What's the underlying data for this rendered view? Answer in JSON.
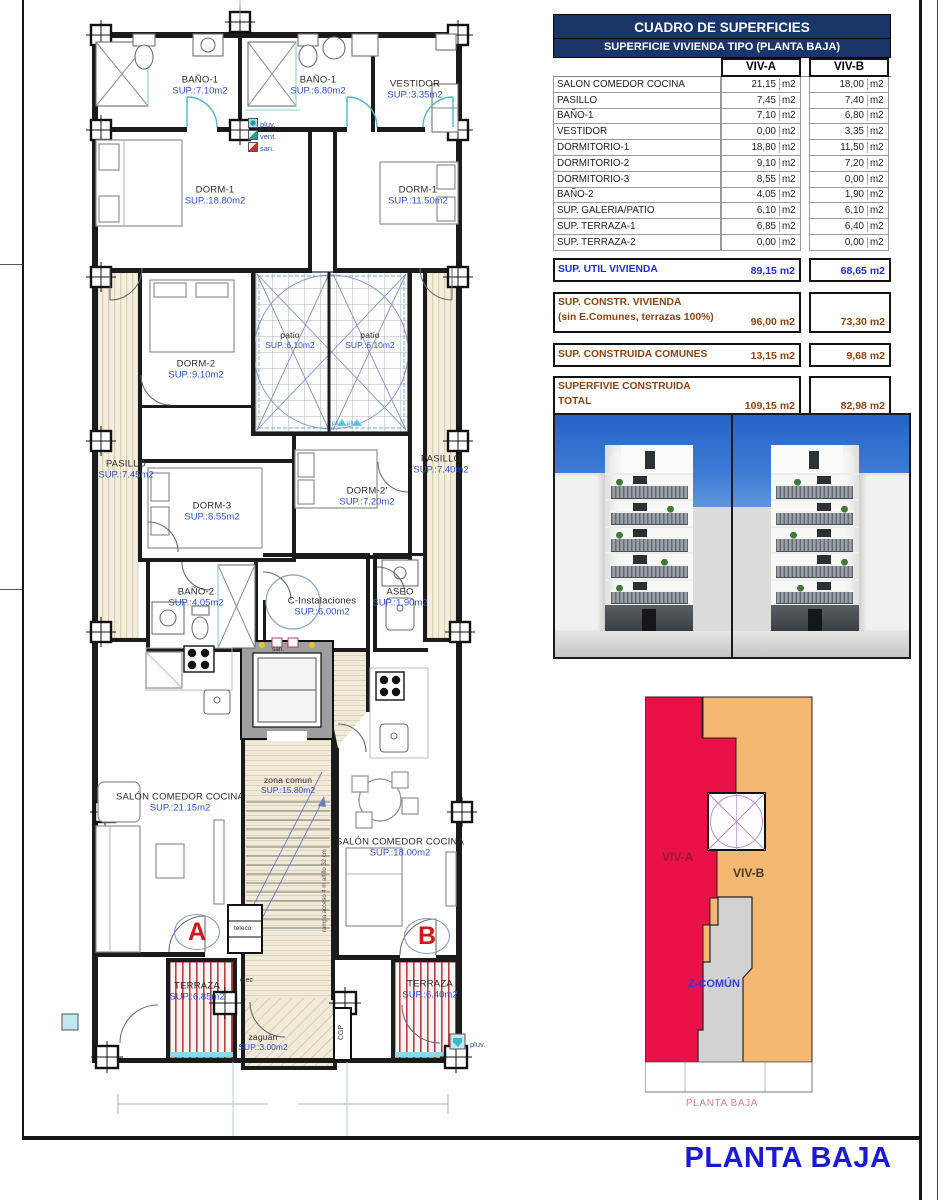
{
  "plan": {
    "rooms": {
      "bano1a": {
        "name": "BAÑO-1",
        "area": "SUP.:7.10m2"
      },
      "bano1b": {
        "name": "BAÑO-1",
        "area": "SUP.:6.80m2"
      },
      "vestidor": {
        "name": "VESTIDOR",
        "area": "SUP.:3.35m2"
      },
      "dorm1a": {
        "name": "DORM-1",
        "area": "SUP.:18.80m2"
      },
      "dorm1b": {
        "name": "DORM-1",
        "area": "SUP.:11.50m2"
      },
      "dorm2": {
        "name": "DORM-2",
        "area": "SUP.:9.10m2"
      },
      "patio1": {
        "name": "patio",
        "area": "SUP.:6.10m2"
      },
      "patio2": {
        "name": "patio",
        "area": "SUP.:6.10m2"
      },
      "pasillo_a": {
        "name": "PASILLO",
        "area": "SUP.:7.45m2"
      },
      "pasillo_b": {
        "name": "PASILLO",
        "area": "SUP.:7.40m2"
      },
      "dorm3": {
        "name": "DORM-3",
        "area": "SUP.:8.55m2"
      },
      "dorm2b": {
        "name": "DORM-2'",
        "area": "SUP.:7.20m2"
      },
      "bano2": {
        "name": "BAÑO-2",
        "area": "SUP.:4.05m2"
      },
      "cinst": {
        "name": "C-Instalaciones",
        "area": "SUP.:6.00m2"
      },
      "aseo": {
        "name": "ASEO",
        "area": "SUP.:1.90m2"
      },
      "salon_a": {
        "name": "SALÓN COMEDOR COCINA",
        "area": "SUP.:21.15m2"
      },
      "zona": {
        "name": "zona comun",
        "area": "SUP.:15.80m2"
      },
      "salon_b": {
        "name": "SALÓN COMEDOR COCINA",
        "area": "SUP.:18.00m2"
      },
      "terraza_a": {
        "name": "TERRAZA",
        "area": "SUP.:6.85m2"
      },
      "terraza_b": {
        "name": "TERRAZA",
        "area": "SUP.:6.40m2"
      },
      "zaguan": {
        "name": "zaguán",
        "area": "SUP.:3.00m2"
      }
    },
    "markers": {
      "letter_a": "A",
      "letter_b": "B",
      "teleco": "teleco",
      "elec": "elec",
      "san": "san.",
      "cgp": "CGP",
      "pluv_bottom": "pluv.",
      "patio_pluv": "pluv. pluv.",
      "ramp_note": "rampa acceso 4 m altillo 32 cm"
    },
    "legend": {
      "pluv": "pluv.",
      "vent": "vent.",
      "san": "san."
    }
  },
  "table": {
    "title": "CUADRO DE SUPERFICIES",
    "subtitle": "SUPERFICIE VIVIENDA TIPO  (PLANTA BAJA)",
    "col_a": "VIV-A",
    "col_b": "VIV-B",
    "unit": "m2",
    "rows": [
      {
        "label": "SALON COMEDOR COCINA",
        "a": "21,15",
        "b": "18,00"
      },
      {
        "label": "PASILLO",
        "a": "7,45",
        "b": "7,40"
      },
      {
        "label": "BAÑO-1",
        "a": "7,10",
        "b": "6,80"
      },
      {
        "label": "VESTIDOR",
        "a": "0,00",
        "b": "3,35"
      },
      {
        "label": "DORMITORIO-1",
        "a": "18,80",
        "b": "11,50"
      },
      {
        "label": "DORMITORIO-2",
        "a": "9,10",
        "b": "7,20"
      },
      {
        "label": "DORMITORIO-3",
        "a": "8,55",
        "b": "0,00"
      },
      {
        "label": "BAÑO-2",
        "a": "4,05",
        "b": "1,90"
      },
      {
        "label": "SUP. GALERIA/PATIO",
        "a": "6,10",
        "b": "6,10"
      },
      {
        "label": "SUP. TERRAZA-1",
        "a": "6,85",
        "b": "6,40"
      },
      {
        "label": "SUP. TERRAZA-2",
        "a": "0,00",
        "b": "0,00"
      }
    ],
    "summary": [
      {
        "label": "SUP. UTIL VIVIENDA",
        "sublabel": "",
        "a": "89,15",
        "b": "68,65"
      },
      {
        "label": "SUP. CONSTR. VIVIENDA",
        "sublabel": "(sin E.Comunes, terrazas 100%)",
        "a": "96,00",
        "b": "73,30"
      },
      {
        "label": "SUP. CONSTRUIDA COMUNES",
        "sublabel": "",
        "a": "13,15",
        "b": "9,68"
      },
      {
        "label": "SUPERFIVIE CONSTRUIDA",
        "sublabel": "TOTAL",
        "a": "109,15",
        "b": "82,98"
      }
    ]
  },
  "diagram": {
    "viv_a": "VIV-A",
    "viv_b": "VIV-B",
    "z_comun": "Z-COMÚN",
    "caption": "PLANTA BAJA"
  },
  "title": {
    "text": "PLANTA BAJA"
  },
  "colors": {
    "header_navy": "#1a3668",
    "room_area_blue": "#3050c8",
    "summary_blue": "#1f2fd0",
    "summary_brown": "#8b4513",
    "viv_a_red": "#ea1048",
    "viv_b_orange": "#f4b873",
    "z_comun_gray": "#d2d2d2",
    "caption_pink": "#d5839b",
    "title_blue": "#1a1ad2"
  }
}
